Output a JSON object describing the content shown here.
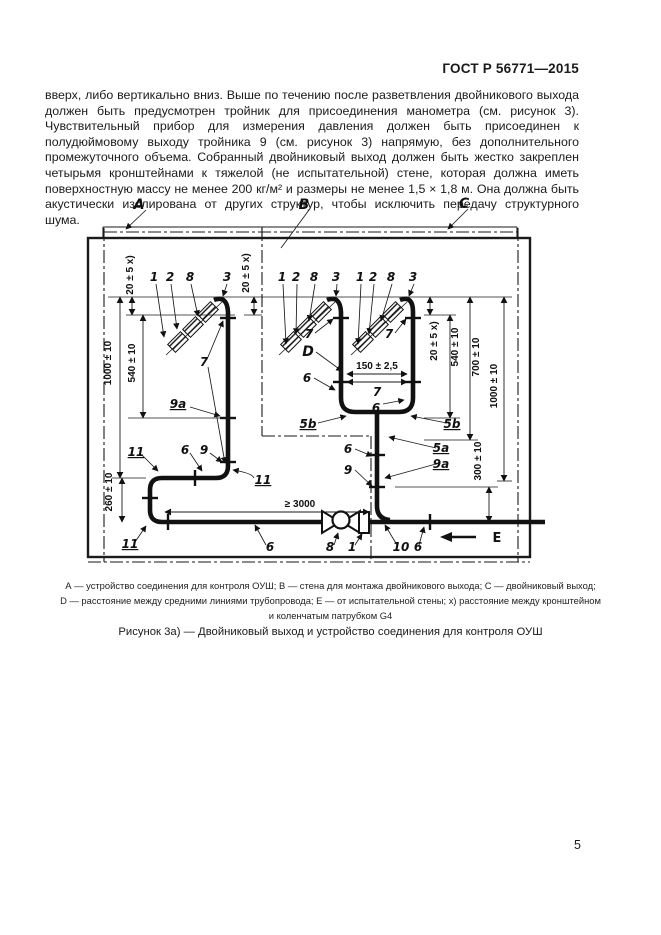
{
  "page": {
    "header": "ГОСТ Р 56771—2015",
    "page_number": "5",
    "body_paragraph": "вверх, либо вертикально вниз. Выше по течению после разветвления двойникового выхода должен быть предусмотрен тройник для присоединения манометра (см. рисунок 3). Чувствительный прибор для измерения давления должен быть присоединен к полудюймовому выходу тройника 9 (см. рисунок 3) напрямую, без дополнительного промежуточного объема. Собранный двойниковый выход должен быть жестко закреплен четырьмя кронштейнами к тяжелой (не испытательной) стене, которая должна иметь поверхностную массу не менее 200 кг/м² и размеры не менее 1,5 × 1,8 м. Она должна быть акустически изолирована от других структур, чтобы исключить передачу структурного шума."
  },
  "figure": {
    "legend_lines": [
      "А — устройство соединения для контроля ОУШ; В — стена для монтажа двойникового выхода; С — двойниковый выход;",
      "D — расстояние между средними линиями трубопровода; Е — от испытательной стены; х) расстояние между кронштейном",
      "и коленчатым патрубком G4"
    ],
    "caption": "Рисунок 3а) — Двойниковый выход и устройство соединения для контроля ОУШ",
    "zones": {
      "a": "A",
      "b": "B",
      "c": "C",
      "d": "D",
      "e": "E"
    },
    "parts": {
      "p1": "1",
      "p2": "2",
      "p3": "3",
      "p5a": "5a",
      "p5b": "5b",
      "p6": "6",
      "p7": "7",
      "p8": "8",
      "p9": "9",
      "p9a": "9a",
      "p10": "10",
      "p11": "11"
    },
    "dims": {
      "d20": "20 ± 5 x)",
      "d150": "150 ± 2,5",
      "d260": "260 ± 10",
      "d300": "300 ± 10",
      "d540": "540 ± 10",
      "d700": "700 ± 10",
      "d1000": "1000 ± 10",
      "d3000": "≥ 3000"
    }
  }
}
